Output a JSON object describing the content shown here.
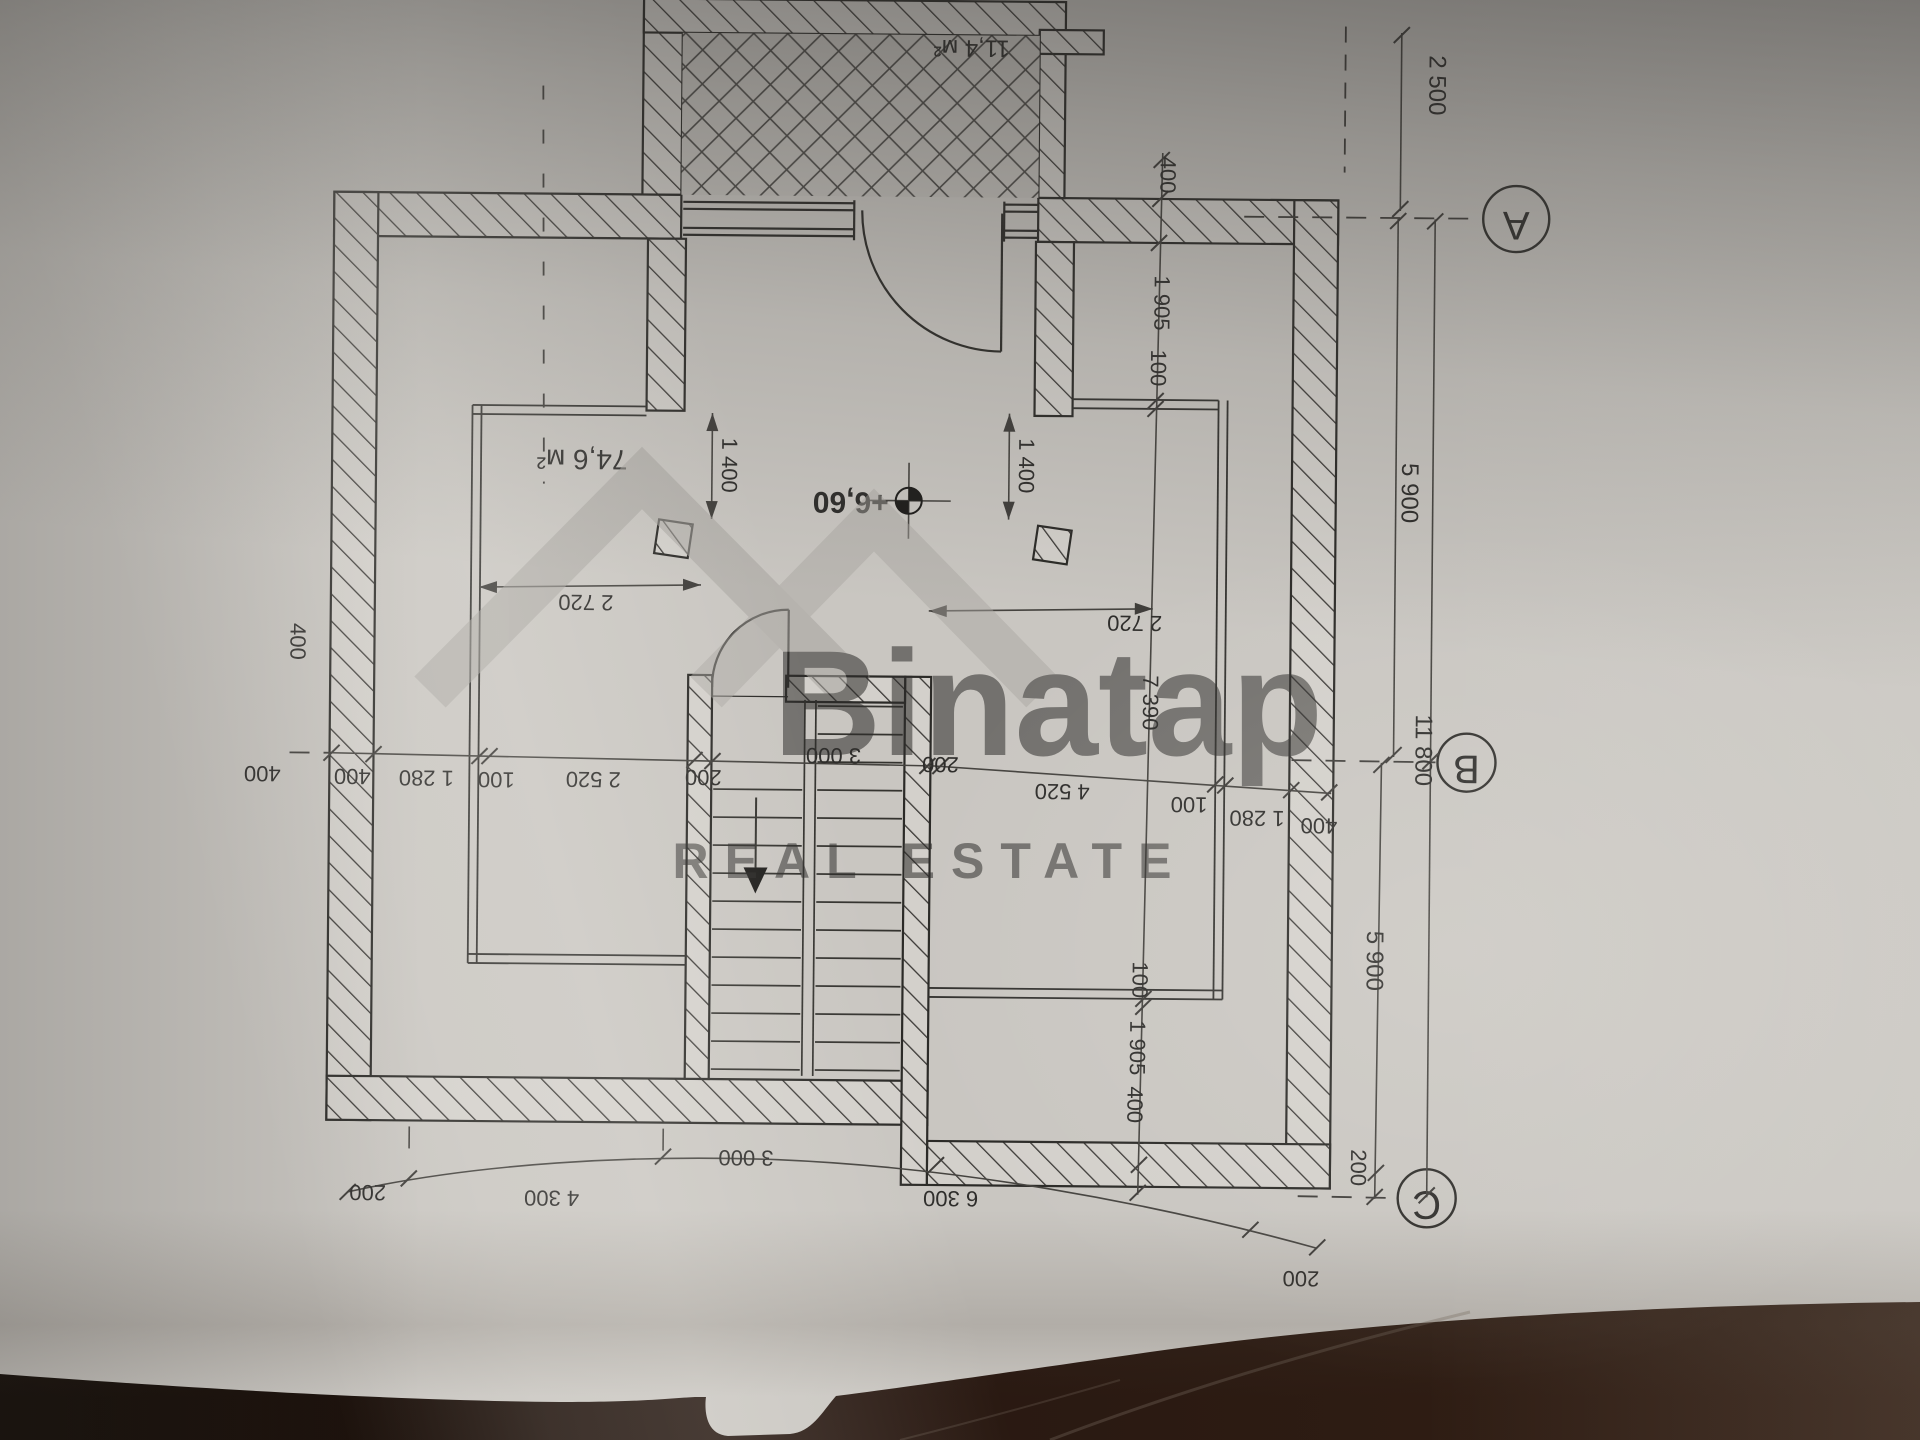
{
  "watermark": {
    "brand": "Binatap",
    "tagline": "REAL ESTATE"
  },
  "grid": {
    "a": "A",
    "b": "B",
    "c": "C"
  },
  "areas": {
    "attic": "74,6 м²",
    "balcony": "11,4 м²"
  },
  "elevation": "+6,60",
  "dims": {
    "offset_top": "2 500",
    "span_ab": "5 900",
    "span_bc": "5 900",
    "total_height": "11 800",
    "offset_c": "200",
    "chain_b": [
      "400",
      "1 280",
      "100",
      "2 520",
      "200",
      "3 000",
      "200",
      "4 520",
      "100",
      "1 280",
      "400"
    ],
    "right_top": [
      "400",
      "1 905",
      "100"
    ],
    "right_bottom": [
      "100",
      "1 905",
      "400"
    ],
    "room_depth": "7 390",
    "opening_left": "1 400",
    "opening_right": "1 400",
    "span_left": "2 720",
    "span_right": "2 720",
    "chain_bottom": [
      "200",
      "4 300",
      "3 000",
      "6 300",
      "200"
    ],
    "wall_left_a": "400",
    "wall_left_b": "400"
  }
}
